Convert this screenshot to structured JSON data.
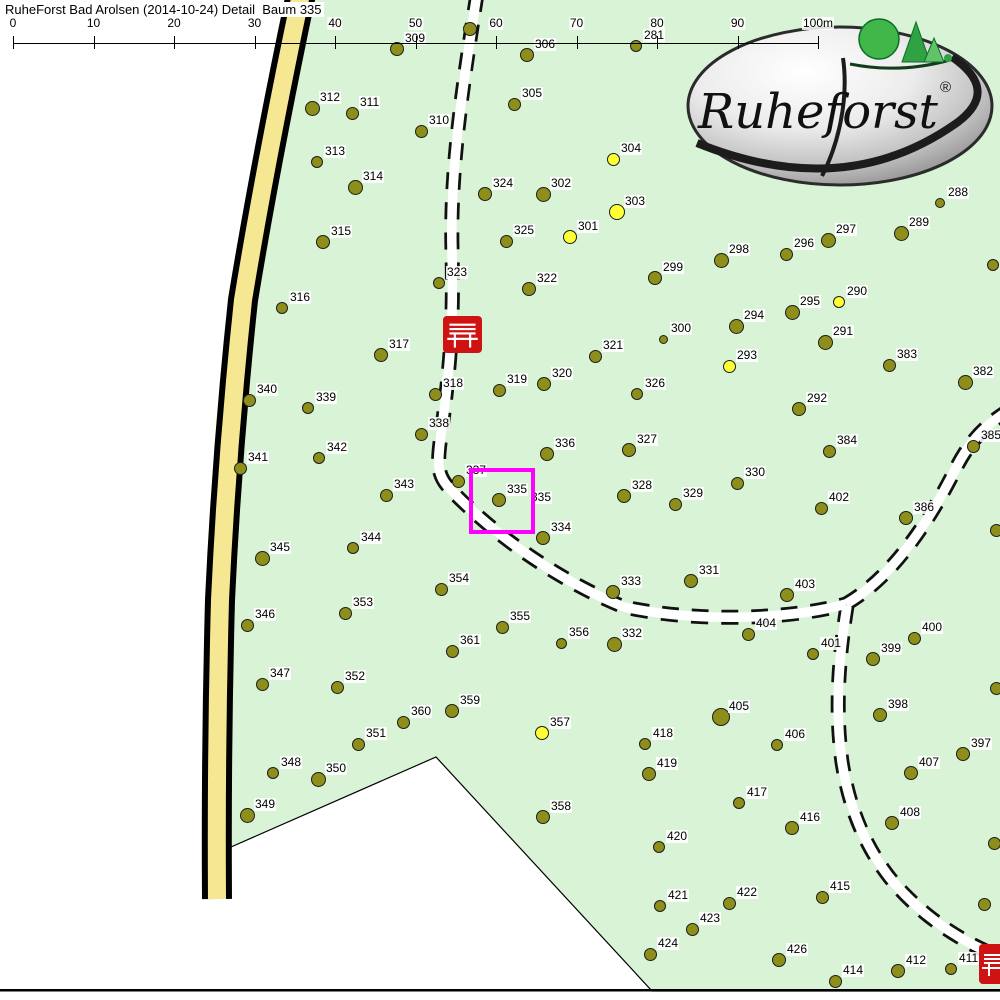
{
  "title": "RuheForst Bad Arolsen (2014-10-24) Detail  Baum 335",
  "scale_bar": {
    "labels": [
      "0",
      "10",
      "20",
      "30",
      "40",
      "50",
      "60",
      "70",
      "80",
      "90",
      "100m"
    ],
    "unit": "m",
    "start_x": 13,
    "step_px": 80.5,
    "line_y": 43
  },
  "logo": {
    "name": "Ruheforst",
    "trademark": "®"
  },
  "highlight": {
    "tree_number": "335",
    "box": {
      "x": 469,
      "y": 468,
      "w": 58,
      "h": 58
    }
  },
  "map": {
    "background_color": "#d9f3d7",
    "tree_color": "#8e8e1b",
    "tree_alt_color": "#ffff33",
    "road_color": "#f6e792",
    "highlight_color": "#ff00ff",
    "bench_color": "#cf1212",
    "benches": [
      {
        "x": 443,
        "y": 316,
        "w": 39,
        "h": 37
      },
      {
        "x": 979,
        "y": 944,
        "w": 34,
        "h": 40
      }
    ],
    "extra_labels": [
      {
        "text": "335",
        "x": 530,
        "y": 491
      }
    ],
    "trees": [
      {
        "n": "309",
        "x": 397,
        "y": 49,
        "c": "o",
        "s": 12
      },
      {
        "n": "",
        "x": 470,
        "y": 29,
        "c": "o",
        "s": 12
      },
      {
        "n": "306",
        "x": 527,
        "y": 55,
        "c": "o",
        "s": 12
      },
      {
        "n": "281",
        "x": 636,
        "y": 46,
        "c": "o",
        "s": 10
      },
      {
        "n": "305",
        "x": 514,
        "y": 104,
        "c": "o",
        "s": 11
      },
      {
        "n": "312",
        "x": 312,
        "y": 108,
        "c": "o",
        "s": 13
      },
      {
        "n": "311",
        "x": 352,
        "y": 113,
        "c": "o",
        "s": 11
      },
      {
        "n": "310",
        "x": 421,
        "y": 131,
        "c": "o",
        "s": 11
      },
      {
        "n": "313",
        "x": 317,
        "y": 162,
        "c": "o",
        "s": 10
      },
      {
        "n": "304",
        "x": 613,
        "y": 159,
        "c": "y",
        "s": 11
      },
      {
        "n": "314",
        "x": 355,
        "y": 187,
        "c": "o",
        "s": 13
      },
      {
        "n": "324",
        "x": 485,
        "y": 194,
        "c": "o",
        "s": 12
      },
      {
        "n": "302",
        "x": 543,
        "y": 194,
        "c": "o",
        "s": 13
      },
      {
        "n": "303",
        "x": 617,
        "y": 212,
        "c": "y",
        "s": 14
      },
      {
        "n": "288",
        "x": 940,
        "y": 203,
        "c": "o",
        "s": 8
      },
      {
        "n": "289",
        "x": 901,
        "y": 233,
        "c": "o",
        "s": 13
      },
      {
        "n": "297",
        "x": 828,
        "y": 240,
        "c": "o",
        "s": 13
      },
      {
        "n": "296",
        "x": 786,
        "y": 254,
        "c": "o",
        "s": 11
      },
      {
        "n": "298",
        "x": 721,
        "y": 260,
        "c": "o",
        "s": 13
      },
      {
        "n": "325",
        "x": 506,
        "y": 241,
        "c": "o",
        "s": 11
      },
      {
        "n": "301",
        "x": 570,
        "y": 237,
        "c": "y",
        "s": 12
      },
      {
        "n": "315",
        "x": 323,
        "y": 242,
        "c": "o",
        "s": 12
      },
      {
        "n": "299",
        "x": 655,
        "y": 278,
        "c": "o",
        "s": 12
      },
      {
        "n": "323",
        "x": 439,
        "y": 283,
        "c": "o",
        "s": 10
      },
      {
        "n": "322",
        "x": 529,
        "y": 289,
        "c": "o",
        "s": 12
      },
      {
        "n": "290",
        "x": 839,
        "y": 302,
        "c": "y",
        "s": 10
      },
      {
        "n": "295",
        "x": 792,
        "y": 312,
        "c": "o",
        "s": 13
      },
      {
        "n": "316",
        "x": 282,
        "y": 308,
        "c": "o",
        "s": 10
      },
      {
        "n": "294",
        "x": 736,
        "y": 326,
        "c": "o",
        "s": 13
      },
      {
        "n": "300",
        "x": 663,
        "y": 339,
        "c": "o",
        "s": 7
      },
      {
        "n": "291",
        "x": 825,
        "y": 342,
        "c": "o",
        "s": 13
      },
      {
        "n": "317",
        "x": 381,
        "y": 355,
        "c": "o",
        "s": 12
      },
      {
        "n": "321",
        "x": 595,
        "y": 356,
        "c": "o",
        "s": 11
      },
      {
        "n": "293",
        "x": 729,
        "y": 366,
        "c": "y",
        "s": 11
      },
      {
        "n": "383",
        "x": 889,
        "y": 365,
        "c": "o",
        "s": 11
      },
      {
        "n": "382",
        "x": 965,
        "y": 382,
        "c": "o",
        "s": 13
      },
      {
        "n": "320",
        "x": 544,
        "y": 384,
        "c": "o",
        "s": 12
      },
      {
        "n": "319",
        "x": 499,
        "y": 390,
        "c": "o",
        "s": 11
      },
      {
        "n": "318",
        "x": 435,
        "y": 394,
        "c": "o",
        "s": 11
      },
      {
        "n": "326",
        "x": 637,
        "y": 394,
        "c": "o",
        "s": 10
      },
      {
        "n": "340",
        "x": 249,
        "y": 400,
        "c": "o",
        "s": 11
      },
      {
        "n": "339",
        "x": 308,
        "y": 408,
        "c": "o",
        "s": 10
      },
      {
        "n": "292",
        "x": 799,
        "y": 409,
        "c": "o",
        "s": 12
      },
      {
        "n": "338",
        "x": 421,
        "y": 434,
        "c": "o",
        "s": 11
      },
      {
        "n": "",
        "x": 993,
        "y": 265,
        "c": "o",
        "s": 10
      },
      {
        "n": "327",
        "x": 629,
        "y": 450,
        "c": "o",
        "s": 12
      },
      {
        "n": "384",
        "x": 829,
        "y": 451,
        "c": "o",
        "s": 11
      },
      {
        "n": "385",
        "x": 973,
        "y": 446,
        "c": "o",
        "s": 11
      },
      {
        "n": "336",
        "x": 547,
        "y": 454,
        "c": "o",
        "s": 12
      },
      {
        "n": "342",
        "x": 319,
        "y": 458,
        "c": "o",
        "s": 10
      },
      {
        "n": "341",
        "x": 240,
        "y": 468,
        "c": "o",
        "s": 11
      },
      {
        "n": "330",
        "x": 737,
        "y": 483,
        "c": "o",
        "s": 11
      },
      {
        "n": "337",
        "x": 458,
        "y": 481,
        "c": "o",
        "s": 11
      },
      {
        "n": "328",
        "x": 624,
        "y": 496,
        "c": "o",
        "s": 12
      },
      {
        "n": "335",
        "x": 499,
        "y": 500,
        "c": "o",
        "s": 12
      },
      {
        "n": "329",
        "x": 675,
        "y": 504,
        "c": "o",
        "s": 11
      },
      {
        "n": "402",
        "x": 821,
        "y": 508,
        "c": "o",
        "s": 11
      },
      {
        "n": "386",
        "x": 906,
        "y": 518,
        "c": "o",
        "s": 12
      },
      {
        "n": "343",
        "x": 386,
        "y": 495,
        "c": "o",
        "s": 11
      },
      {
        "n": "334",
        "x": 543,
        "y": 538,
        "c": "o",
        "s": 12
      },
      {
        "n": "344",
        "x": 353,
        "y": 548,
        "c": "o",
        "s": 10
      },
      {
        "n": "345",
        "x": 262,
        "y": 558,
        "c": "o",
        "s": 13
      },
      {
        "n": "354",
        "x": 441,
        "y": 589,
        "c": "o",
        "s": 11
      },
      {
        "n": "333",
        "x": 613,
        "y": 592,
        "c": "o",
        "s": 12
      },
      {
        "n": "331",
        "x": 691,
        "y": 581,
        "c": "o",
        "s": 12
      },
      {
        "n": "403",
        "x": 787,
        "y": 595,
        "c": "o",
        "s": 12
      },
      {
        "n": "353",
        "x": 345,
        "y": 613,
        "c": "o",
        "s": 11
      },
      {
        "n": "346",
        "x": 247,
        "y": 625,
        "c": "o",
        "s": 11
      },
      {
        "n": "355",
        "x": 502,
        "y": 627,
        "c": "o",
        "s": 11
      },
      {
        "n": "356",
        "x": 561,
        "y": 643,
        "c": "o",
        "s": 9
      },
      {
        "n": "332",
        "x": 614,
        "y": 644,
        "c": "o",
        "s": 13
      },
      {
        "n": "404",
        "x": 748,
        "y": 634,
        "c": "o",
        "s": 11
      },
      {
        "n": "401",
        "x": 813,
        "y": 654,
        "c": "o",
        "s": 10
      },
      {
        "n": "400",
        "x": 914,
        "y": 638,
        "c": "o",
        "s": 11
      },
      {
        "n": "399",
        "x": 873,
        "y": 659,
        "c": "o",
        "s": 12
      },
      {
        "n": "361",
        "x": 452,
        "y": 651,
        "c": "o",
        "s": 11
      },
      {
        "n": "347",
        "x": 262,
        "y": 684,
        "c": "o",
        "s": 11
      },
      {
        "n": "352",
        "x": 337,
        "y": 687,
        "c": "o",
        "s": 11
      },
      {
        "n": "398",
        "x": 880,
        "y": 715,
        "c": "o",
        "s": 12
      },
      {
        "n": "405",
        "x": 721,
        "y": 717,
        "c": "o",
        "s": 16
      },
      {
        "n": "359",
        "x": 452,
        "y": 711,
        "c": "o",
        "s": 12
      },
      {
        "n": "360",
        "x": 403,
        "y": 722,
        "c": "o",
        "s": 11
      },
      {
        "n": "357",
        "x": 542,
        "y": 733,
        "c": "y",
        "s": 12
      },
      {
        "n": "418",
        "x": 645,
        "y": 744,
        "c": "o",
        "s": 10
      },
      {
        "n": "406",
        "x": 777,
        "y": 745,
        "c": "o",
        "s": 10
      },
      {
        "n": "351",
        "x": 358,
        "y": 744,
        "c": "o",
        "s": 11
      },
      {
        "n": "397",
        "x": 963,
        "y": 754,
        "c": "o",
        "s": 12
      },
      {
        "n": "407",
        "x": 911,
        "y": 773,
        "c": "o",
        "s": 12
      },
      {
        "n": "419",
        "x": 649,
        "y": 774,
        "c": "o",
        "s": 12
      },
      {
        "n": "348",
        "x": 273,
        "y": 773,
        "c": "o",
        "s": 10
      },
      {
        "n": "350",
        "x": 318,
        "y": 779,
        "c": "o",
        "s": 13
      },
      {
        "n": "417",
        "x": 739,
        "y": 803,
        "c": "o",
        "s": 10
      },
      {
        "n": "349",
        "x": 247,
        "y": 815,
        "c": "o",
        "s": 13
      },
      {
        "n": "358",
        "x": 543,
        "y": 817,
        "c": "o",
        "s": 12
      },
      {
        "n": "416",
        "x": 792,
        "y": 828,
        "c": "o",
        "s": 12
      },
      {
        "n": "408",
        "x": 892,
        "y": 823,
        "c": "o",
        "s": 12
      },
      {
        "n": "420",
        "x": 659,
        "y": 847,
        "c": "o",
        "s": 10
      },
      {
        "n": "",
        "x": 994,
        "y": 843,
        "c": "o",
        "s": 11
      },
      {
        "n": "415",
        "x": 822,
        "y": 897,
        "c": "o",
        "s": 11
      },
      {
        "n": "422",
        "x": 729,
        "y": 903,
        "c": "o",
        "s": 11
      },
      {
        "n": "421",
        "x": 660,
        "y": 906,
        "c": "o",
        "s": 10
      },
      {
        "n": "",
        "x": 984,
        "y": 904,
        "c": "o",
        "s": 11
      },
      {
        "n": "423",
        "x": 692,
        "y": 929,
        "c": "o",
        "s": 11
      },
      {
        "n": "424",
        "x": 650,
        "y": 954,
        "c": "o",
        "s": 11
      },
      {
        "n": "426",
        "x": 779,
        "y": 960,
        "c": "o",
        "s": 12
      },
      {
        "n": "414",
        "x": 835,
        "y": 981,
        "c": "o",
        "s": 11
      },
      {
        "n": "412",
        "x": 898,
        "y": 971,
        "c": "o",
        "s": 12
      },
      {
        "n": "411",
        "x": 951,
        "y": 969,
        "c": "o",
        "s": 10
      },
      {
        "n": "",
        "x": 996,
        "y": 688,
        "c": "o",
        "s": 11
      },
      {
        "n": "",
        "x": 996,
        "y": 530,
        "c": "o",
        "s": 11
      }
    ]
  }
}
